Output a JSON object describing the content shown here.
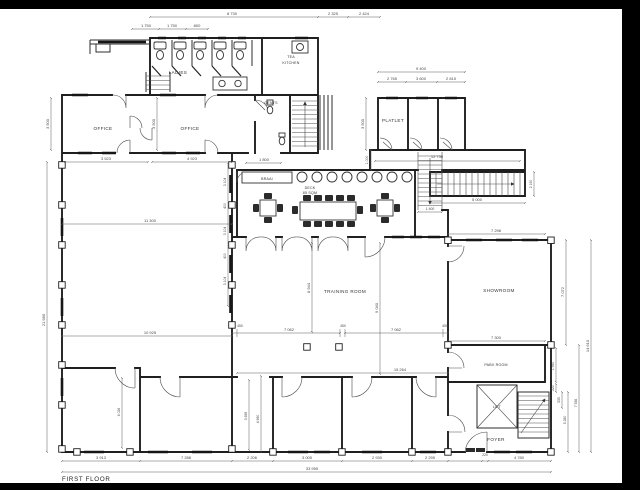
{
  "title": "FIRST FLOOR",
  "rooms": {
    "office_left": "OFFICE",
    "office_mid": "OFFICE",
    "ladies": "LADIES",
    "tea_kitchen_line1": "TEA",
    "tea_kitchen_line2": "KITCHEN",
    "gents": "GENTS",
    "platlet": "PLATLET",
    "braai": "BRAAI",
    "deck": "DECK",
    "deck_area": "85 SQM",
    "training": "TRAINING ROOM",
    "showroom": "SHOWROOM",
    "pabx": "PABX ROOM",
    "lift": "LIFT",
    "foyer": "FOYER"
  },
  "dims": {
    "top_total": "8 730",
    "top_a": "2 325",
    "top_b": "2 424",
    "stall_1": "1 750",
    "stall_2": "1 750",
    "stall_3": "800",
    "office1_w": "3 523",
    "office2_w": "4 923",
    "office1_h": "3 500",
    "office2_h": "3 500",
    "gents_w": "1 800",
    "left_total": "21 980",
    "span_upper": "11 300",
    "span_lower": "10 925",
    "grid_1": "3 104",
    "grid_2": "400",
    "grid_3": "3 104",
    "grid_4": "400",
    "grid_5": "3 104",
    "platlet_total": "9 400",
    "platlet_1": "2 765",
    "platlet_2": "3 600",
    "platlet_3": "2 815",
    "platlet_h": "3 500",
    "corridor_l": "12 730",
    "corridor_w": "1 000",
    "stair_e_h": "2 150",
    "stair_e_w": "5 000",
    "stair_m_w": "1 400",
    "training_h1": "8 944",
    "training_h2": "9 040",
    "training_w1": "7 062",
    "training_w2": "7 062",
    "col_a": "450",
    "col_b": "450",
    "col_c": "450",
    "training_total": "15 264",
    "room_left_h": "6 026",
    "gap_h1": "3 695",
    "gap_h2": "4 690",
    "showroom_w1": "7 298",
    "showroom_w2": "7 300",
    "showroom_h": "7 072",
    "right_total": "14 610",
    "pabx_h": "1 550",
    "pabx_s": "220",
    "lift_s": "535",
    "foyer_h": "5 280",
    "right_lower": "7 536",
    "bottom_1": "3 913",
    "bottom_2": "7 288",
    "bottom_3": "2 206",
    "bottom_4": "3 005",
    "bottom_5": "2 930",
    "bottom_6": "2 295",
    "bottom_7": "220",
    "bottom_8": "4 780",
    "bottom_total": "33 955"
  }
}
